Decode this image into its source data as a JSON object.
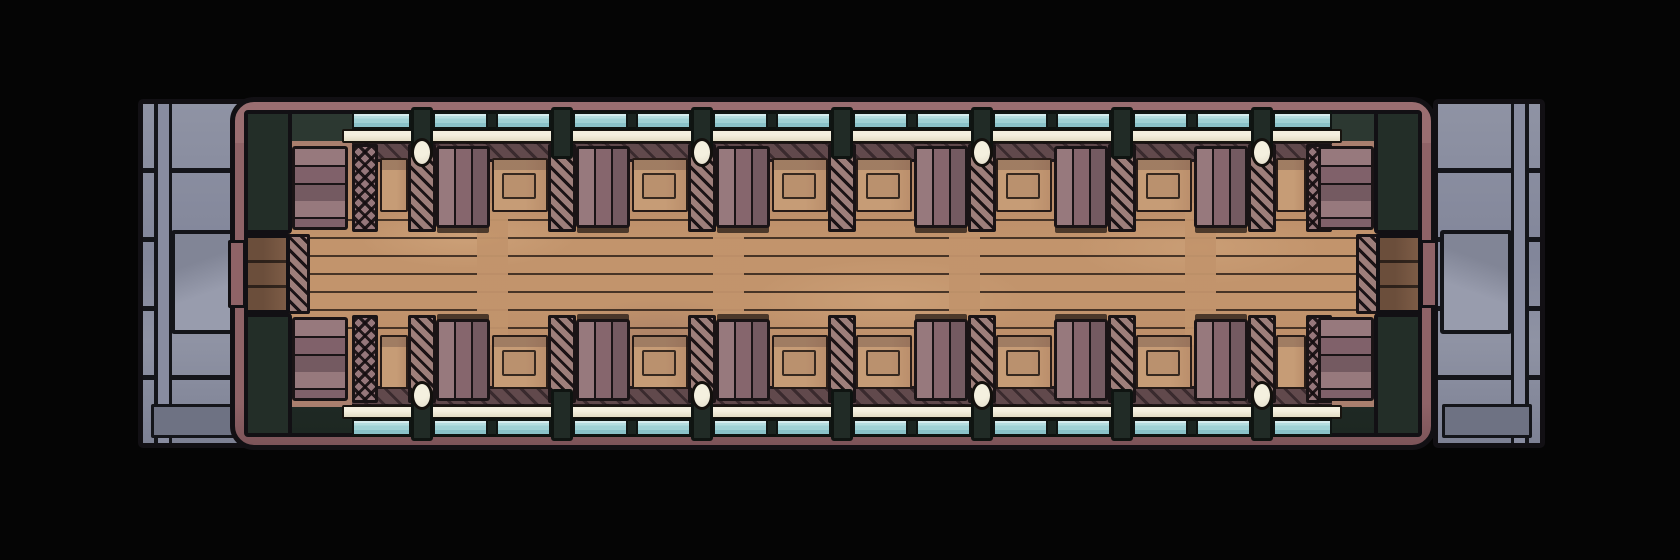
{
  "scene": {
    "type": "top-down battle map",
    "subject": "railway passenger carriage interior with boarding platforms at both ends",
    "background": "#050505"
  },
  "palette": {
    "outline": "#121014",
    "platform_light": "#8f93a4",
    "platform_mid": "#82869a",
    "platform_dark": "#6e7283",
    "car_band_mauve": "#8f6367",
    "wall_dark": "#232e28",
    "window_blue": "#a7d4d7",
    "window_blue_deep": "#8ac2c9",
    "sill_cream": "#ede7d4",
    "lamp_cream": "#e9e4cc",
    "bench_light": "#97797d",
    "bench_mid": "#86666d",
    "bench_dark": "#745a61",
    "hatch_fill": "#9d7e7a",
    "table_wood": "#c69c76",
    "floor_center": "#c2946c",
    "floor_edge": "#a87e6e",
    "aisle_line": "#221712",
    "door_wood": "#6b4e3b",
    "door_wood_light": "#7d5c46"
  },
  "carriage": {
    "windows_per_wall": 14,
    "window_pillars_per_wall": 7,
    "wall_lamps_per_wall": 4,
    "seat_partitions_per_wall": 7,
    "benches_per_wall": 6,
    "end_benches": 4,
    "luggage_tables_per_wall": 8,
    "doors": 2,
    "end_platforms": 2
  }
}
